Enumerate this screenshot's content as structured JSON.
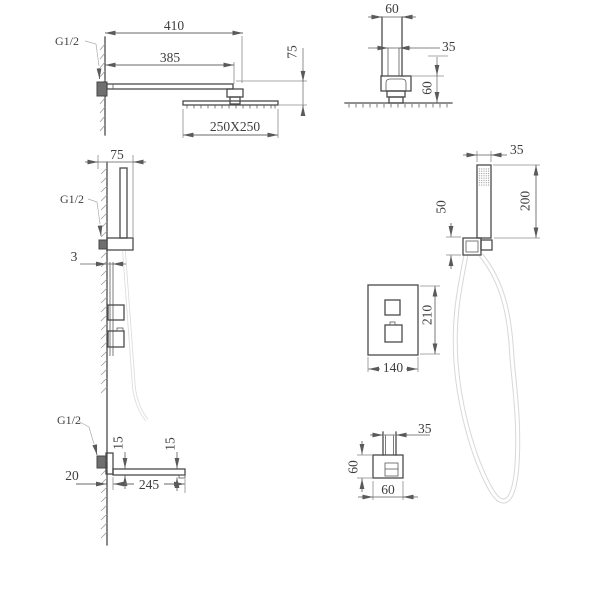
{
  "labels": {
    "overhead_side": {
      "thread": "G1/2",
      "d410": "410",
      "d385": "385",
      "d75": "75",
      "head": "250X250"
    },
    "overhead_front": {
      "d60_width": "60",
      "d35": "35",
      "d60_height": "60"
    },
    "hand_side": {
      "d75": "75",
      "thread": "G1/2",
      "d3": "3"
    },
    "hand_front": {
      "d35": "35",
      "d200": "200",
      "d50": "50"
    },
    "valve": {
      "d210": "210",
      "d140": "140"
    },
    "spout": {
      "thread": "G1/2",
      "d15_inner": "15",
      "d15_tip": "15",
      "d20": "20",
      "d245": "245"
    },
    "outlet": {
      "d35": "35",
      "d60_height": "60",
      "d60_width": "60"
    }
  },
  "colors": {
    "background": "#ffffff",
    "object_line": "#4a4a4a",
    "dimension_line": "#848484",
    "text": "#3e3e3e",
    "dark_fill": "#6f6f6f",
    "hose": "#d8d8d8",
    "hatch": "#9c9c9c"
  }
}
